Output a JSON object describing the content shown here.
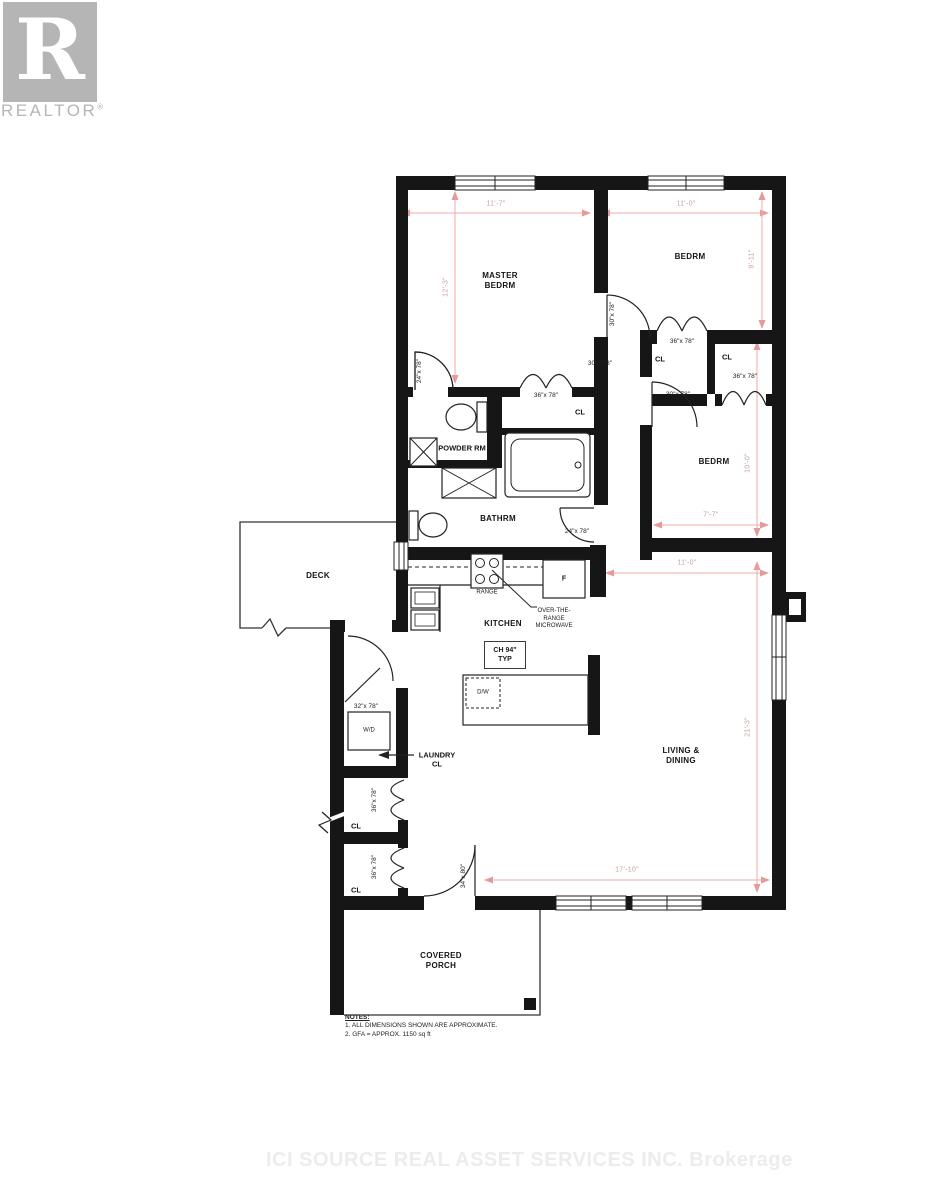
{
  "colors": {
    "wall": "#161616",
    "dimension_line": "#f0a8a8",
    "logo": "#b5b5b5",
    "watermark": "#edecea"
  },
  "logo": {
    "letter": "R",
    "wordmark": "REALTOR",
    "registered": "®"
  },
  "watermark": "ICI SOURCE REAL ASSET SERVICES INC. Brokerage",
  "rooms": {
    "master": "MASTER\nBEDRM",
    "bedroom_top": "BEDRM",
    "bedroom_mid": "BEDRM",
    "powder": "POWDER RM",
    "bath": "BATHRM",
    "kitchen": "KITCHEN",
    "living": "LIVING &\nDINING",
    "laundry": "LAUNDRY\nCL",
    "deck": "DECK",
    "porch": "COVERED\nPORCH",
    "closet": "CL"
  },
  "dimensions": {
    "master_width": "11'-7\"",
    "bedroom_top_width": "11'-0\"",
    "master_depth": "12'-3\"",
    "bedroom_top_depth": "9'-11\"",
    "bedroom_mid_depth": "10'-0\"",
    "bedroom_mid_width": "7'-7\"",
    "living_width": "11'-0\"",
    "living_depth": "21'-3\"",
    "living_bottom_width": "17'-10\""
  },
  "doors": {
    "powder": "24\"x 78\"",
    "master_closet": "36\"x 78\"",
    "master_entry": "30\"x 78\"",
    "hall": "30\"x 78\"",
    "bedroom_top_closet": "36\"x 78\"",
    "bedroom_mid_entry": "30\"x 78\"",
    "bedroom_mid_closet": "36\"x 78\"",
    "bath": "24\"x 78\"",
    "laundry": "32\"x 78\"",
    "hall_closet_1": "36\"x 78\"",
    "hall_closet_2": "36\"x 78\"",
    "entry": "34\"x 80\""
  },
  "kitchen": {
    "range": "RANGE",
    "microwave": "OVER-THE-\nRANGE\nMICROWAVE",
    "fridge": "F",
    "ceiling_height": "CH 94\"\nTYP",
    "dishwasher": "D/W",
    "washer_dryer": "W/D"
  },
  "notes": {
    "title": "NOTES:",
    "line1": "1. ALL DIMENSIONS SHOWN ARE APPROXIMATE.",
    "line2": "2. GFA = APPROX. 1150 sq ft"
  }
}
